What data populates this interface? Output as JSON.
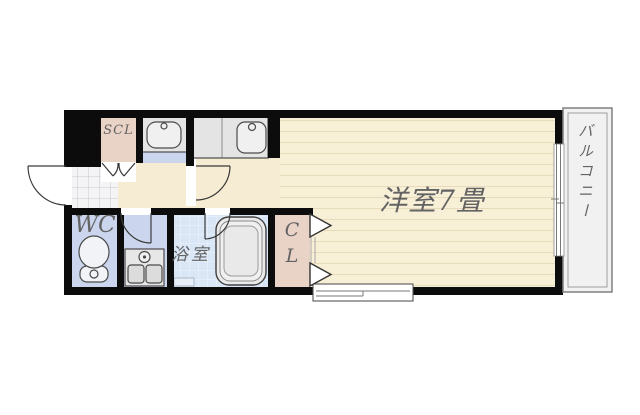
{
  "rooms": {
    "main_room": {
      "label": "洋室7畳"
    },
    "balcony": {
      "label": "バルコニー"
    },
    "bathroom": {
      "label": "浴室"
    },
    "toilet": {
      "label": "WC"
    },
    "closet": {
      "label_line1": "C",
      "label_line2": "L"
    },
    "shoe_closet": {
      "label": "SCL"
    }
  },
  "colors": {
    "wall": "#0c0c0c",
    "room_floor": "#f8efd7",
    "plank_line": "#e8dbbc",
    "hall_floor": "#f6ecd3",
    "wet_floor": "#cbd5ee",
    "bath_floor": "#d9e6f5",
    "closet_floor": "#e9d2c6",
    "tile_floor": "#f4f4f6",
    "fixture_fill": "#e4e4e4",
    "balcony_floor": "#f1f1f1",
    "label_text": "#636363"
  }
}
